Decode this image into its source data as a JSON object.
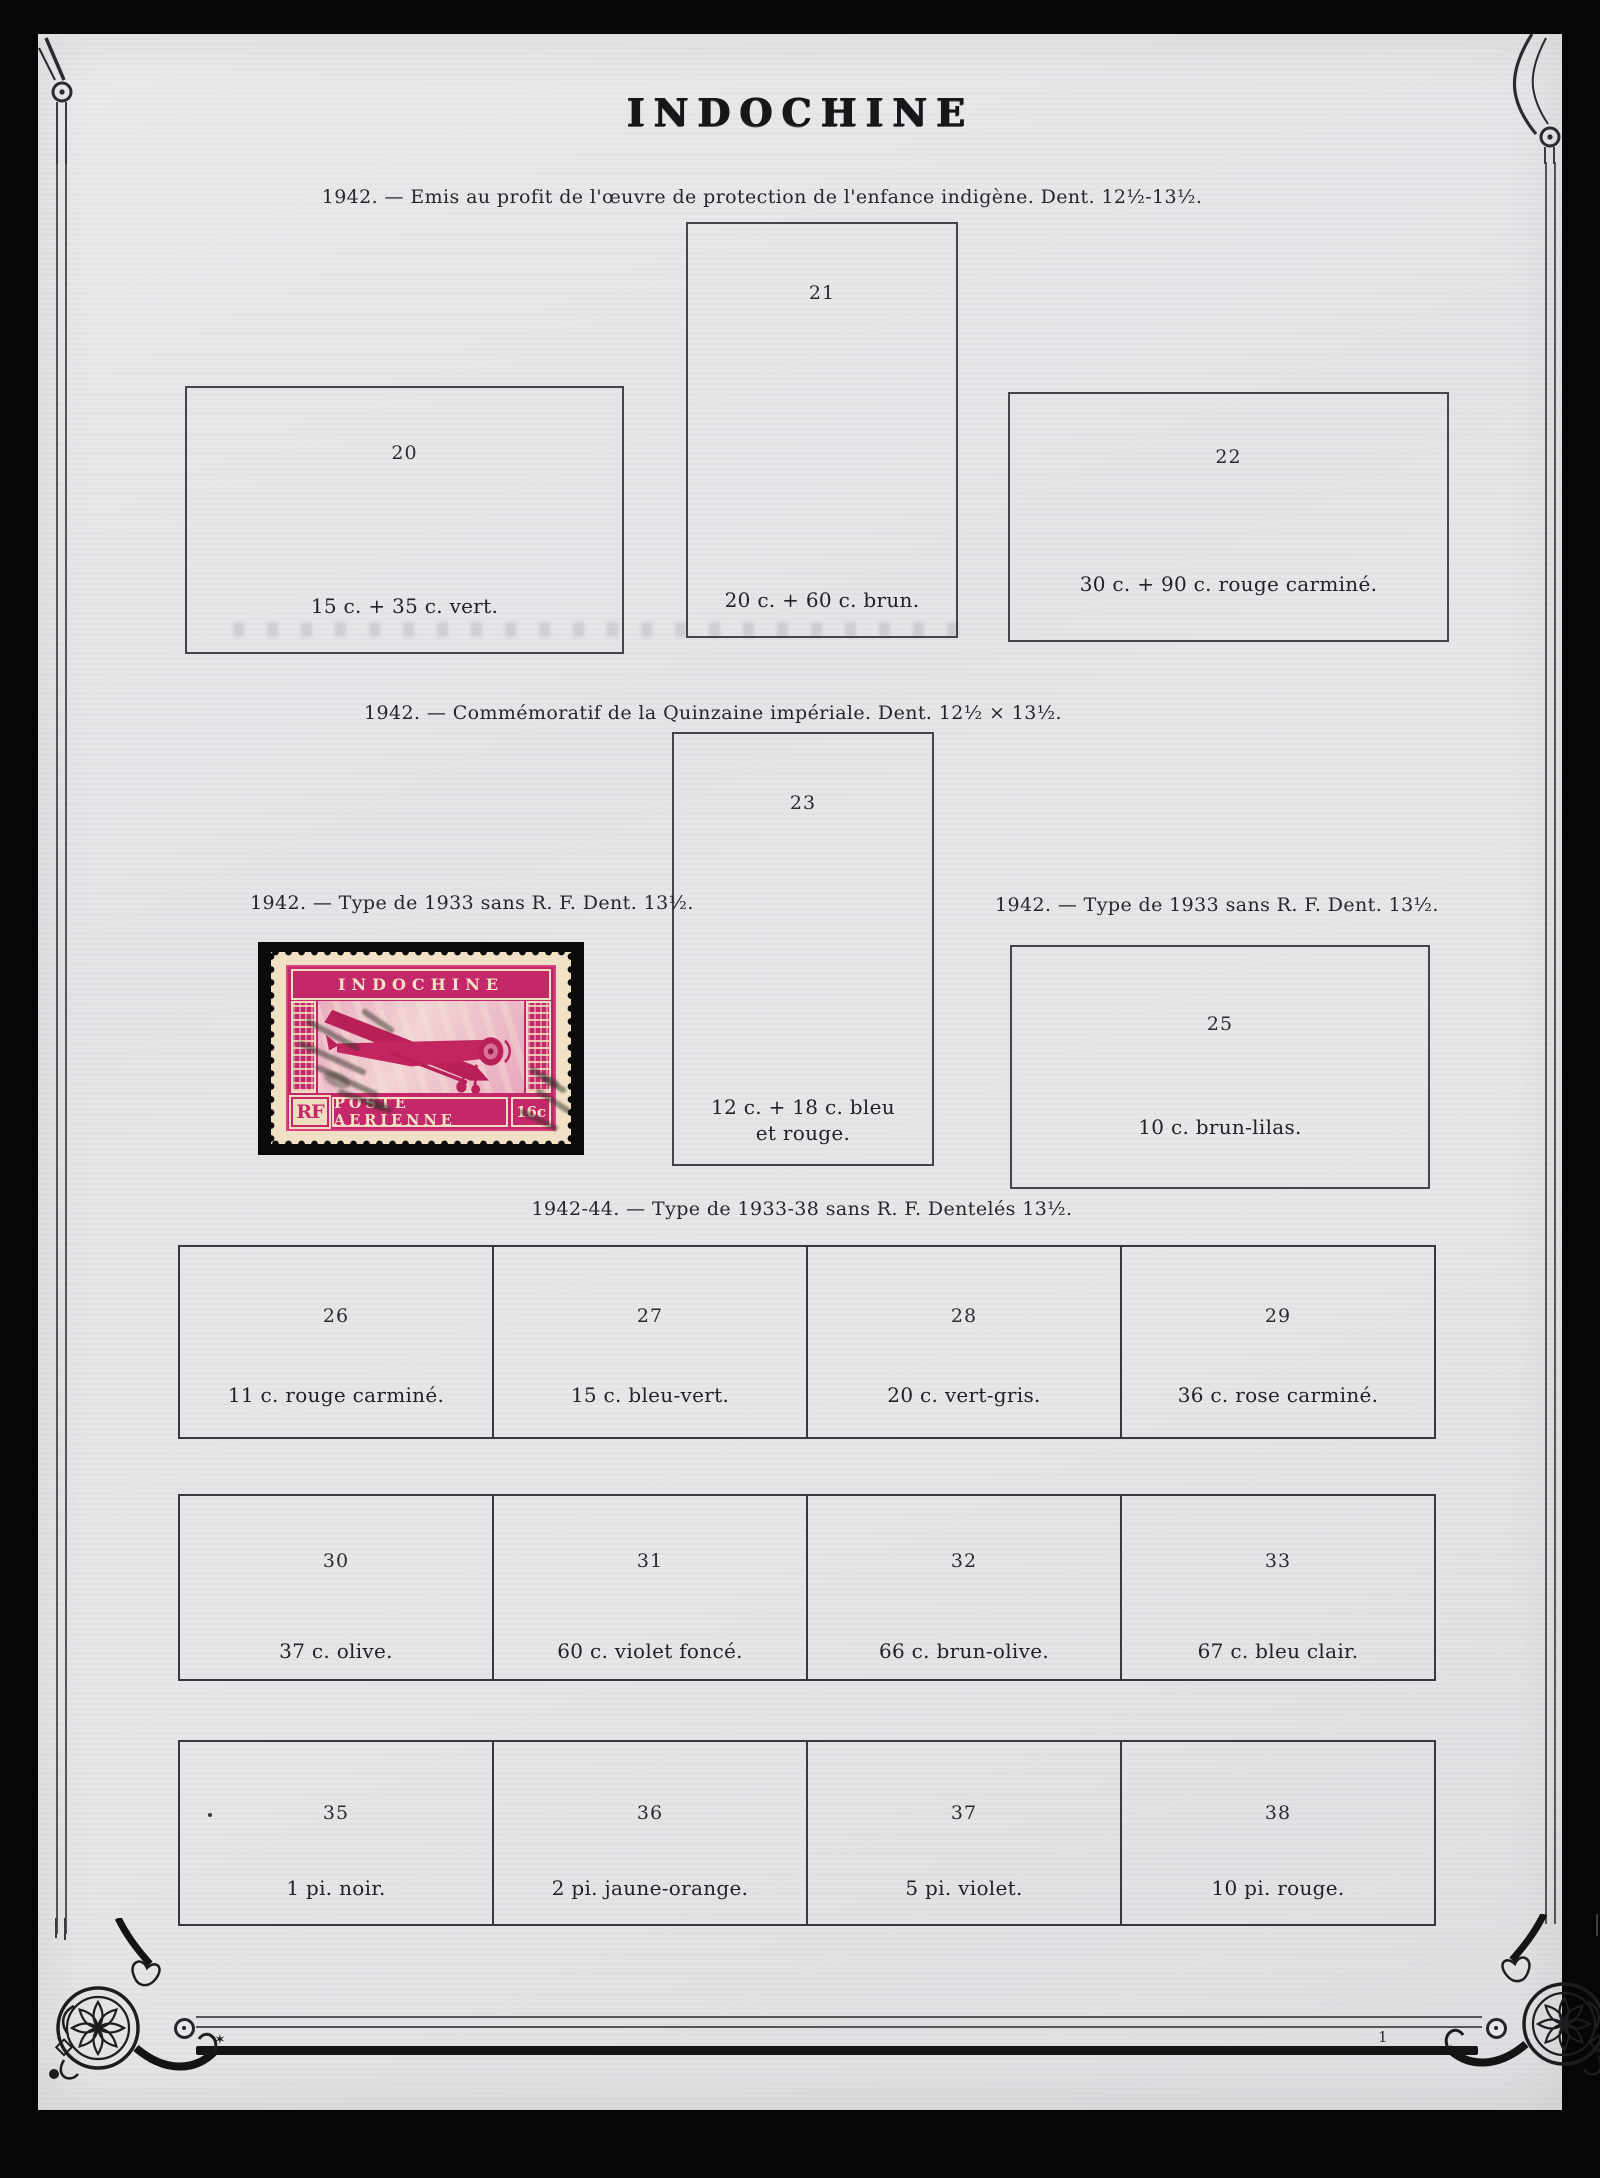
{
  "page": {
    "title": "INDOCHINE",
    "footer": {
      "star": "✶",
      "page_number": "1"
    }
  },
  "sections": {
    "enfance": {
      "caption": "1942. — Emis au profit de l'œuvre de protection de l'enfance indigène. Dent. 12½-13½."
    },
    "quinzaine": {
      "caption": "1942. — Commémoratif de la Quinzaine impériale. Dent. 12½ × 13½."
    },
    "type1933_left": {
      "caption": "1942. — Type de 1933 sans R. F. Dent. 13½."
    },
    "type1933_right": {
      "caption": "1942. — Type de 1933 sans R. F. Dent. 13½."
    },
    "type1933_38": {
      "caption": "1942-44. — Type de 1933-38 sans R. F. Dentelés 13½."
    }
  },
  "slots": {
    "s20": {
      "number": "20",
      "label": "15 c. + 35 c. vert."
    },
    "s21": {
      "number": "21",
      "label": "20 c. + 60 c. brun."
    },
    "s22": {
      "number": "22",
      "label": "30 c. + 90 c. rouge carminé."
    },
    "s23": {
      "number": "23",
      "label": "12 c. + 18 c. bleu et rouge."
    },
    "s25": {
      "number": "25",
      "label": "10 c. brun-lilas."
    },
    "s26": {
      "number": "26",
      "label": "11 c. rouge carminé."
    },
    "s27": {
      "number": "27",
      "label": "15 c. bleu-vert."
    },
    "s28": {
      "number": "28",
      "label": "20 c. vert-gris."
    },
    "s29": {
      "number": "29",
      "label": "36 c. rose carminé."
    },
    "s30": {
      "number": "30",
      "label": "37 c. olive."
    },
    "s31": {
      "number": "31",
      "label": "60 c. violet foncé."
    },
    "s32": {
      "number": "32",
      "label": "66 c. brun-olive."
    },
    "s33": {
      "number": "33",
      "label": "67 c. bleu clair."
    },
    "s35": {
      "number": "35",
      "label": "1 pi. noir."
    },
    "s36": {
      "number": "36",
      "label": "2 pi. jaune-orange."
    },
    "s37": {
      "number": "37",
      "label": "5 pi. violet."
    },
    "s38": {
      "number": "38",
      "label": "10 pi. rouge."
    }
  },
  "stamp": {
    "country": "INDOCHINE",
    "inscription": "POSTE AERIENNE",
    "monogram": "RF",
    "value": "16c",
    "ink_color": "#c5286a",
    "paper_color": "#efe0c6"
  }
}
